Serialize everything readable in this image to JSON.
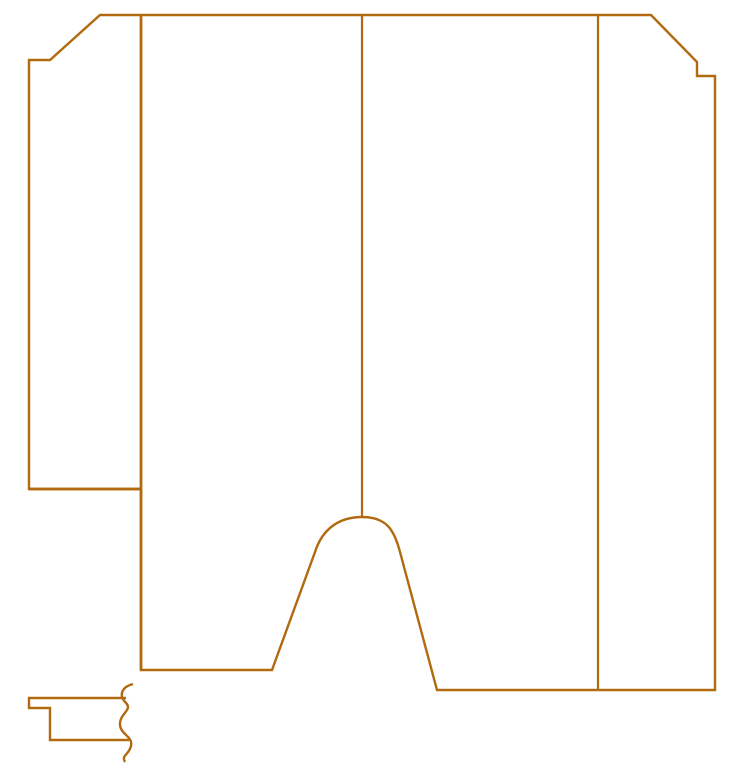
{
  "meta": {
    "description": "CAD-style cutting pattern line drawing, no text labels",
    "background_color": "#ffffff",
    "stroke_color": "#b26a10"
  },
  "canvas": {
    "width": 734,
    "height": 767
  },
  "shapes": [
    {
      "name": "main-panel-outline",
      "role": "outer boundary of large pattern piece with chamfered top corners, right step notch, left flap and bottom arch cutout",
      "d": "M 100 15 L 651 15 L 697 62 L 697 76 L 715 76 L 715 690 L 437 690 L 400 552 C 394 529 386 517 362 517 C 338 517 322 530 315 552 L 272 670 L 141 670 L 141 489 L 29 489 L 29 60 L 50 60 Z",
      "width": 2.4
    },
    {
      "name": "fold-line-left-flap",
      "role": "interior vertical line separating left flap from main panel",
      "d": "M 141 15 L 141 670",
      "width": 2.8
    },
    {
      "name": "flap-bottom-line",
      "role": "horizontal line at bottom of left flap",
      "d": "M 29 489 L 141 489",
      "width": 2.8
    },
    {
      "name": "divider-line-middle",
      "role": "interior vertical divider ending at arch peak",
      "d": "M 362 15 L 362 517",
      "width": 2.2
    },
    {
      "name": "divider-line-right",
      "role": "interior vertical divider running to bottom edge",
      "d": "M 598 15 L 598 690",
      "width": 2.2
    },
    {
      "name": "detail-piece-outline",
      "role": "small cross-section detail piece at bottom left, open toward break line",
      "d": "M 126 698 L 29 698 L 29 708 L 50 708 L 50 740 L 129 740",
      "width": 2.4
    },
    {
      "name": "break-line-squiggle",
      "role": "wavy break/continuation symbol on right end of detail piece",
      "d": "M 133 684 C 122 687 118 695 126 703 C 133 710 119 714 120 725 C 121 735 133 736 131 746 C 129 755 121 755 125 762",
      "width": 2.4
    }
  ]
}
